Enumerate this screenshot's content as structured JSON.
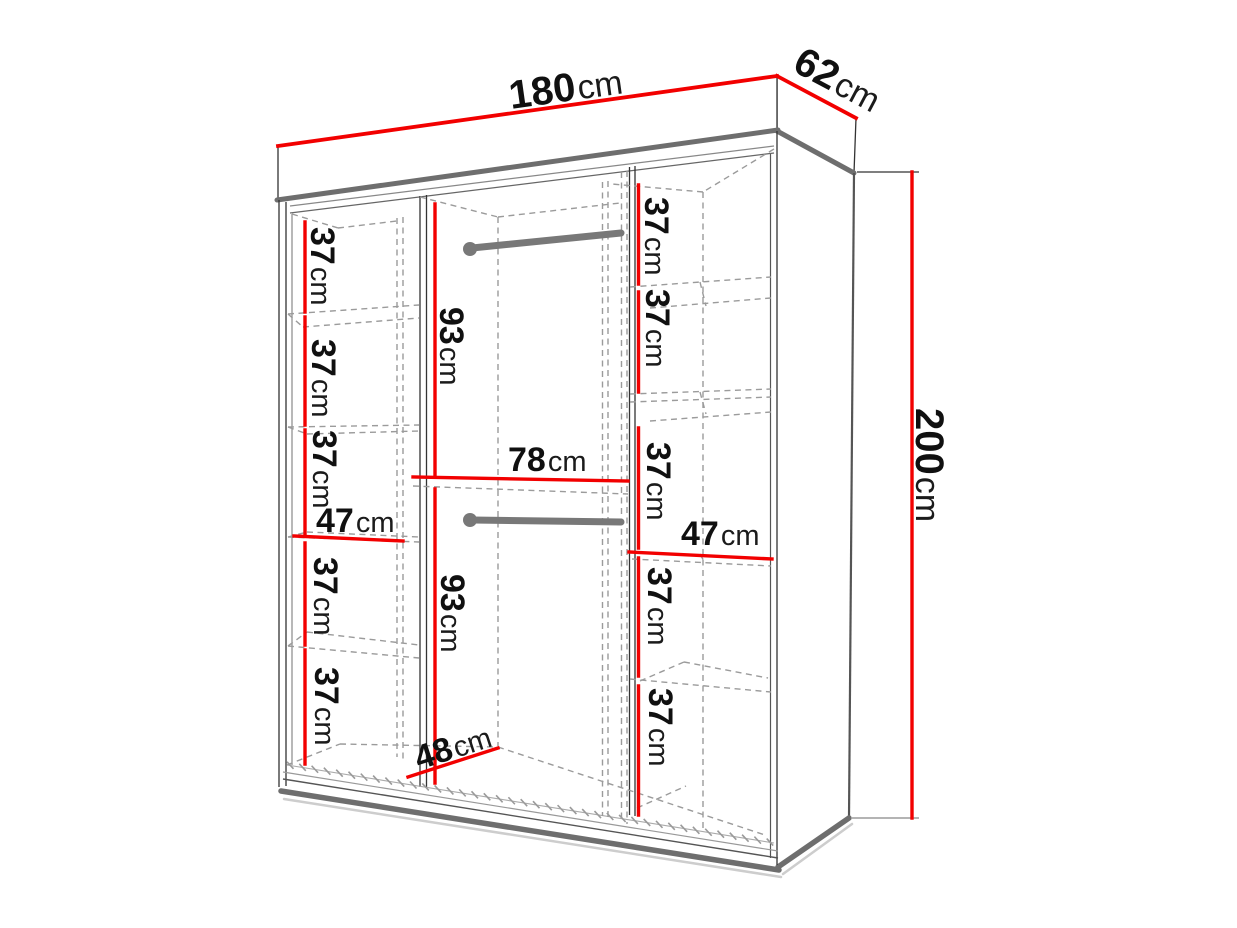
{
  "diagram_title": "wardrobe-dimension-diagram",
  "labels": {
    "width": {
      "value": "180",
      "unit": "cm"
    },
    "depth": {
      "value": "62",
      "unit": "cm"
    },
    "height": {
      "value": "200",
      "unit": "cm"
    },
    "left_column": {
      "shelves": [
        {
          "value": "37",
          "unit": "cm"
        },
        {
          "value": "37",
          "unit": "cm"
        },
        {
          "value": "37",
          "unit": "cm"
        },
        {
          "value": "37",
          "unit": "cm"
        },
        {
          "value": "37",
          "unit": "cm"
        }
      ],
      "width": {
        "value": "47",
        "unit": "cm"
      }
    },
    "middle_section": {
      "upper_hanging_height": {
        "value": "93",
        "unit": "cm"
      },
      "inner_width": {
        "value": "78",
        "unit": "cm"
      },
      "lower_hanging_height": {
        "value": "93",
        "unit": "cm"
      },
      "floor_depth": {
        "value": "48",
        "unit": "cm"
      }
    },
    "right_column": {
      "shelves": [
        {
          "value": "37",
          "unit": "cm"
        },
        {
          "value": "37",
          "unit": "cm"
        },
        {
          "value": "37",
          "unit": "cm"
        },
        {
          "value": "37",
          "unit": "cm"
        },
        {
          "value": "37",
          "unit": "cm"
        }
      ],
      "width": {
        "value": "47",
        "unit": "cm"
      }
    }
  },
  "colors": {
    "dimension_line": "#f20000",
    "outline": "#333333",
    "thick_edge": "#6e6e6e",
    "dashed_line": "#9b9b9b",
    "rod": "#787878",
    "background": "#ffffff"
  }
}
